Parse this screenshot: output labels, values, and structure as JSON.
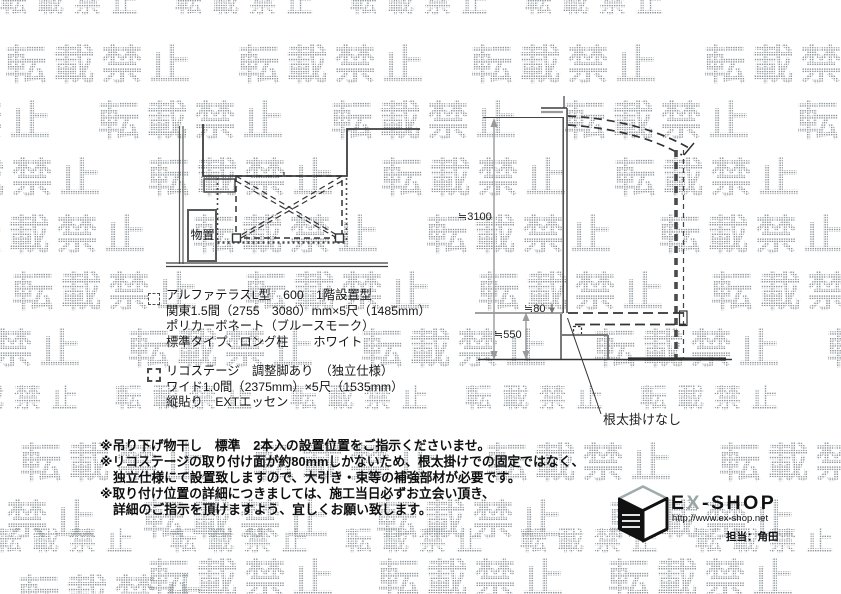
{
  "watermark": {
    "text": "転載禁止"
  },
  "plan": {
    "storage_label": "物置"
  },
  "elevation": {
    "dim_height": "≒3100",
    "dim_step_height": "≒550",
    "dim_face": "≒80",
    "leader_label": "根太掛けなし"
  },
  "legend": {
    "terrace": {
      "lines": [
        "アルファテラスL型　600　1階設置型",
        "関東1.5間（2755　3080）mm×5尺（1485mm）",
        "ポリカーボネート（ブルースモーク）",
        "標準タイプ、ロング柱　　ホワイト"
      ]
    },
    "deck": {
      "lines": [
        "リコステージ　調整脚あり　（独立仕様）",
        "ワイド1.0間（2375mm）×5尺（1535mm）",
        "縦貼り　EXTエッセン"
      ]
    }
  },
  "notes": [
    "※吊り下げ物干し　標準　2本入の設置位置をご指示くださいませ。",
    "※リコステージの取り付け面が約80mmしかないため、根太掛けでの固定ではなく、",
    "独立仕様にて設置致しますので、大引き・束等の補強部材が必要です。",
    "※取り付け位置の詳細につきましては、施工当日必ずお立会い頂き、",
    "詳細のご指示を頂けますよう、宜しくお願い致します。"
  ],
  "footer": {
    "brand_parts": [
      "E",
      "X",
      "-SHOP"
    ],
    "url": "http://www.ex-shop.net",
    "contact": "担当：角田"
  }
}
